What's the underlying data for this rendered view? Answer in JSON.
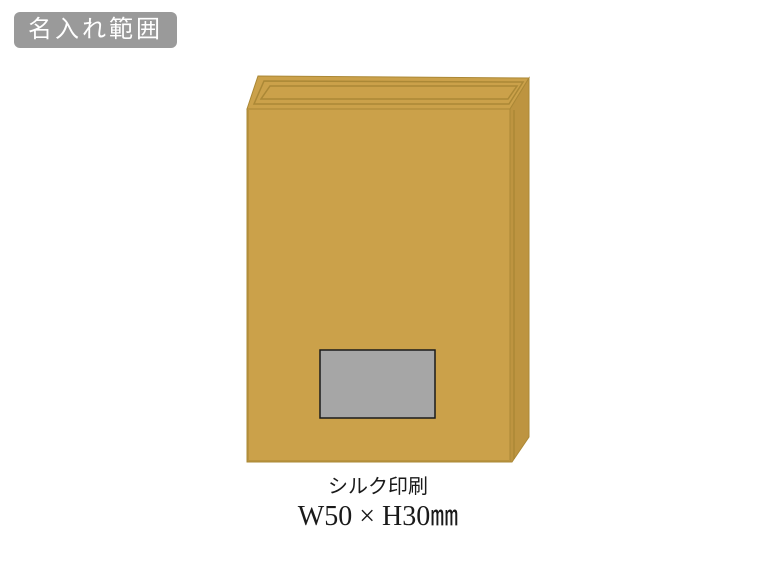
{
  "badge": {
    "label": "名入れ範囲",
    "bg_color": "#9a9a9a",
    "text_color": "#ffffff"
  },
  "print_area": {
    "method": "シルク印刷",
    "size": "W50 × H30㎜"
  },
  "colors": {
    "background": "#ffffff",
    "box_face": "#cba14a",
    "box_side": "#bd9440",
    "box_edge_line": "#ab8836",
    "print_area_fill": "#a6a6a6",
    "print_area_border": "#1a1a1a",
    "caption_text": "#1a1a1a"
  }
}
